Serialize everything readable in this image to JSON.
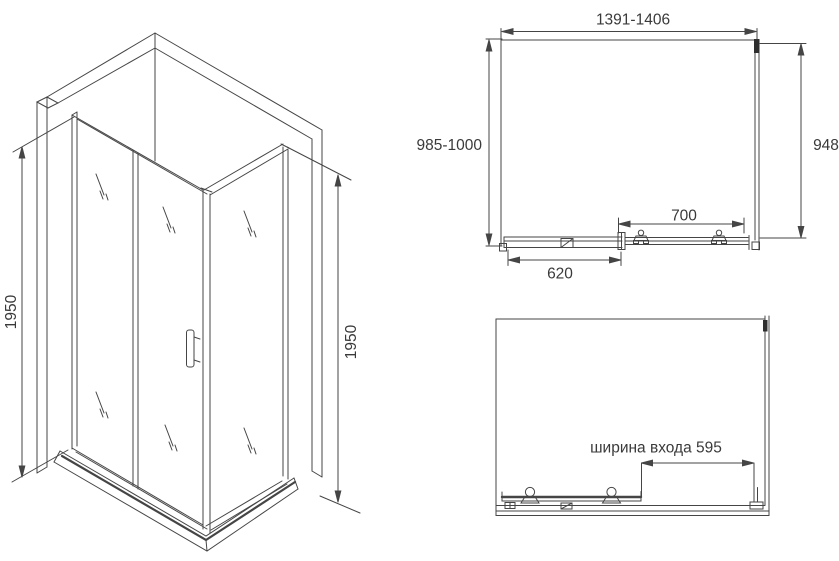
{
  "colors": {
    "line": "#454545",
    "text": "#3a3a3a",
    "background": "#ffffff"
  },
  "isometric_view": {
    "height_left_mm": "1950",
    "height_right_mm": "1950"
  },
  "plan_view": {
    "overall_width": "1391-1406",
    "overall_depth": "985-1000",
    "side_panel_depth": "948",
    "door_section": "700",
    "fixed_section": "620"
  },
  "front_view": {
    "entrance_width": "ширина входа 595"
  }
}
